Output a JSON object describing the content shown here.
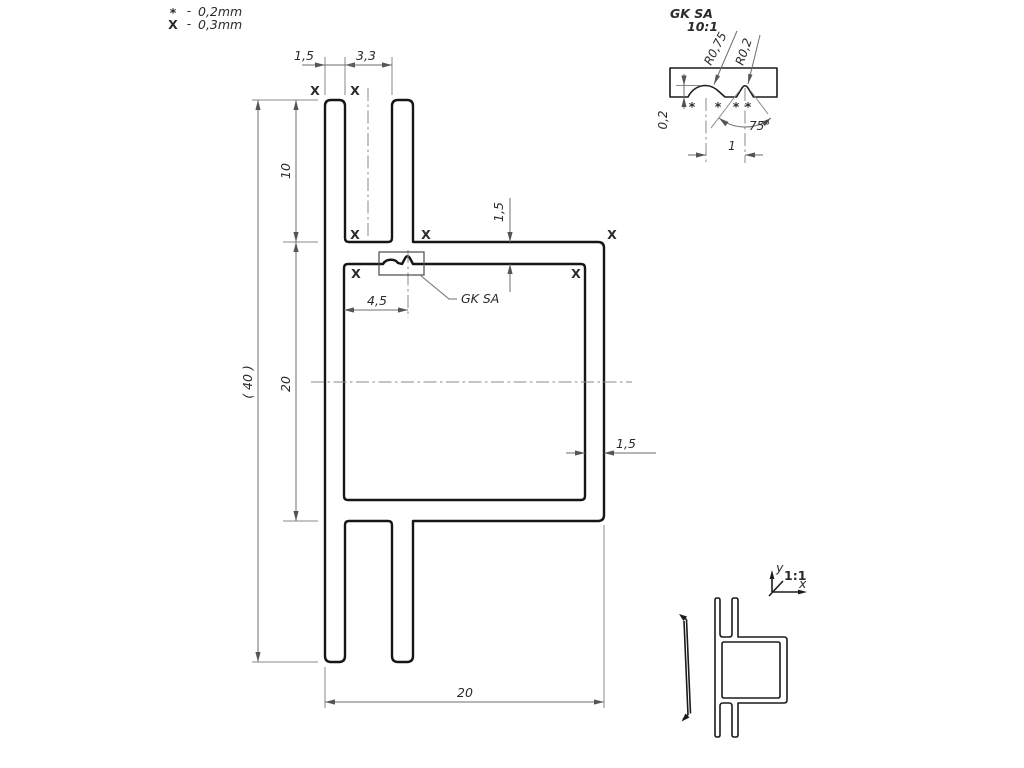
{
  "legend": {
    "rows": [
      {
        "mark": "*",
        "dash": "-",
        "value": "0,2mm"
      },
      {
        "mark": "X",
        "dash": "-",
        "value": "0,3mm"
      }
    ]
  },
  "detail_view": {
    "title": "GK SA",
    "scale": "10:1",
    "dim_radius_large": "R0,75",
    "dim_radius_small": "R0,2",
    "dim_angle": "75°",
    "dim_depth": "0,2",
    "dim_pitch": "1",
    "surface_mark": "*"
  },
  "main_view": {
    "dim_wall_width": "1,5",
    "dim_slot_width": "3,3",
    "dim_fin_height": "10",
    "dim_tube_height": "20",
    "dim_total_height": "( 40 )",
    "dim_groove_offset": "4,5",
    "dim_top_wall": "1,5",
    "dim_right_wall": "1,5",
    "dim_width": "20",
    "groove_label": "GK SA",
    "surface_mark": "X"
  },
  "scale_view": {
    "scale_label": "1:1",
    "axis_x": "x",
    "axis_y": "y"
  }
}
